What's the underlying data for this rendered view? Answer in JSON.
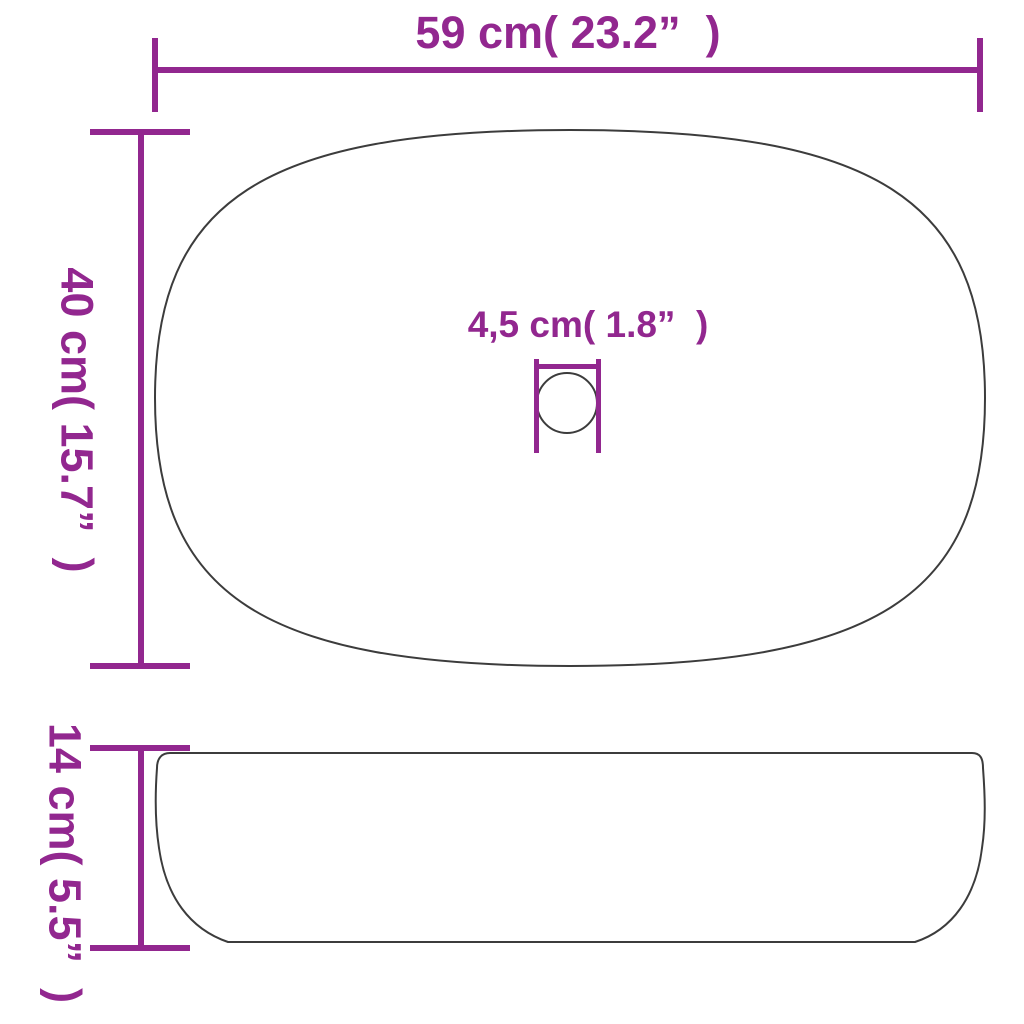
{
  "colors": {
    "dimension": "#92278F",
    "outline": "#3c3c3c",
    "background": "#ffffff"
  },
  "top_view": {
    "width_label": "59 cm( 23.2”  )",
    "height_label": "40 cm( 15.7”  )",
    "drain_label": "4,5 cm( 1.8”  )"
  },
  "side_view": {
    "height_label": "14 cm( 5.5”  )"
  }
}
